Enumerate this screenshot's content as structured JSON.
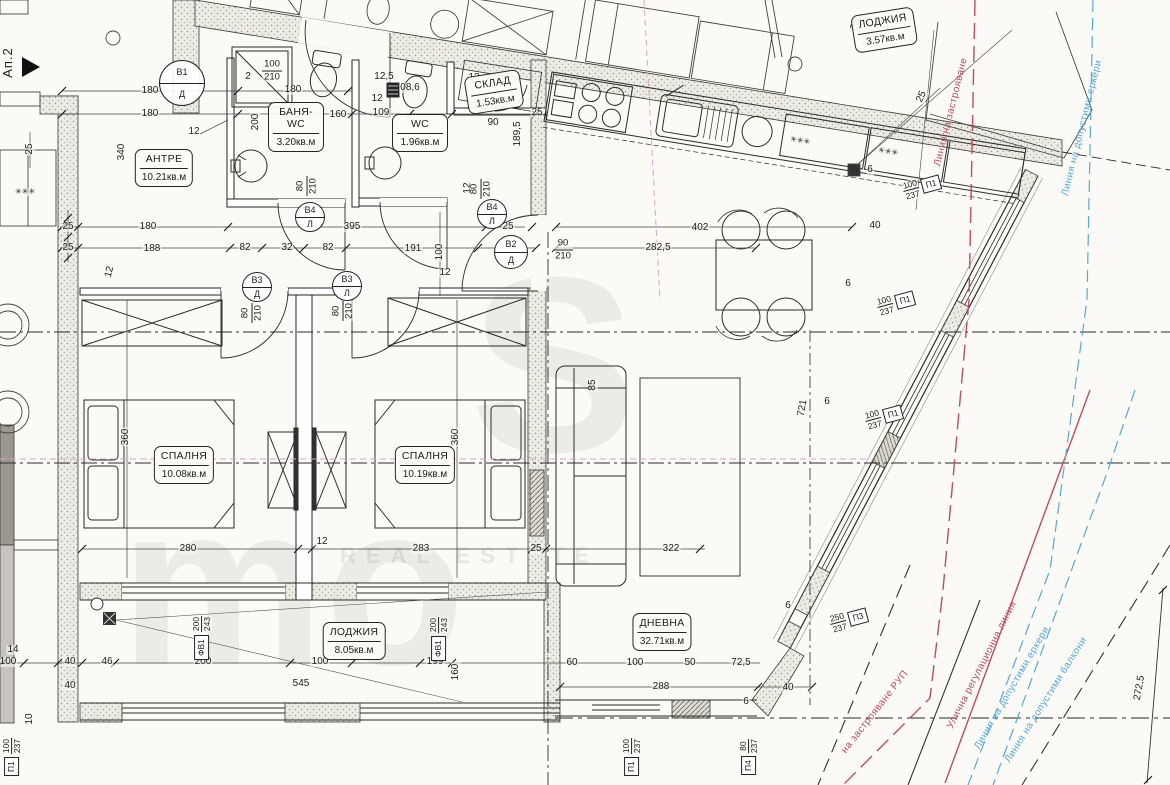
{
  "meta": {
    "apartment": "Ап.2",
    "colors": {
      "red_line": "#b94f63",
      "blue_line": "#58a8d5",
      "ink": "#1d1d1b"
    }
  },
  "watermark": {
    "letters1": "S",
    "letters2": "mo",
    "caption": "REAL ESTATE"
  },
  "rooms": [
    {
      "name": "АНТРЕ",
      "area": "10.21кв.м",
      "x": 164,
      "y": 168
    },
    {
      "name": "БАНЯ-WC",
      "area": "3.20кв.м",
      "x": 296,
      "y": 127
    },
    {
      "name": "WC",
      "area": "1.96кв.м",
      "x": 420,
      "y": 133
    },
    {
      "name": "СКЛАД",
      "area": "1.53кв.м",
      "x": 494,
      "y": 92,
      "r": -9
    },
    {
      "name": "СПАЛНЯ",
      "area": "10.08кв.м",
      "x": 184,
      "y": 465
    },
    {
      "name": "СПАЛНЯ",
      "area": "10.19кв.м",
      "x": 425,
      "y": 465
    },
    {
      "name": "ДНЕВНА",
      "area": "32.71кв.м",
      "x": 662,
      "y": 632
    },
    {
      "name": "ЛОДЖИЯ",
      "area": "8.05кв.м",
      "x": 354,
      "y": 641
    },
    {
      "name": "ЛОДЖИЯ",
      "area": "3.57кв.м",
      "x": 884,
      "y": 30,
      "r": -9
    }
  ],
  "door_markers": [
    {
      "top": "В1",
      "bottom": "Д",
      "x": 182,
      "y": 83,
      "s": 46
    },
    {
      "top": "В2",
      "bottom": "Д",
      "x": 511,
      "y": 252,
      "s": 34
    },
    {
      "top": "В3",
      "bottom": "Д",
      "x": 257,
      "y": 287,
      "s": 30
    },
    {
      "top": "В3",
      "bottom": "Л",
      "x": 347,
      "y": 286,
      "s": 30
    },
    {
      "top": "В4",
      "bottom": "Л",
      "x": 310,
      "y": 217,
      "s": 30
    },
    {
      "top": "В4",
      "bottom": "Л",
      "x": 492,
      "y": 214,
      "s": 30
    }
  ],
  "fractions": [
    {
      "a": "100",
      "b": "210",
      "x": 272,
      "y": 71
    },
    {
      "a": "90",
      "b": "210",
      "x": 563,
      "y": 250
    },
    {
      "a": "80",
      "b": "210",
      "x": 252,
      "y": 313,
      "r": -90
    },
    {
      "a": "80",
      "b": "210",
      "x": 343,
      "y": 311,
      "r": -90
    },
    {
      "a": "80",
      "b": "210",
      "x": 307,
      "y": 186,
      "r": -90
    },
    {
      "a": "80",
      "b": "210",
      "x": 481,
      "y": 189,
      "r": -90
    }
  ],
  "win_markers": [
    {
      "a": "100",
      "b": "237",
      "tag": "П1",
      "x": 922,
      "y": 187,
      "r": -15
    },
    {
      "a": "100",
      "b": "237",
      "tag": "П1",
      "x": 896,
      "y": 303,
      "r": -15
    },
    {
      "a": "100",
      "b": "237",
      "tag": "П1",
      "x": 884,
      "y": 417,
      "r": -15
    },
    {
      "a": "250",
      "b": "237",
      "tag": "П3",
      "x": 849,
      "y": 620,
      "r": -15
    },
    {
      "a": "100",
      "b": "237",
      "tag": "П1",
      "x": 632,
      "y": 757,
      "r": -90,
      "cls": "v"
    },
    {
      "a": "80",
      "b": "237",
      "tag": "П4",
      "x": 749,
      "y": 757,
      "r": -90,
      "cls": "v"
    },
    {
      "a": "100",
      "b": "237",
      "tag": "П1",
      "x": 12,
      "y": 757,
      "r": -90,
      "cls": "v"
    },
    {
      "a": "200",
      "b": "243",
      "tag": "ФВ1",
      "x": 202,
      "y": 638,
      "r": -90,
      "cls": "v"
    },
    {
      "a": "200",
      "b": "243",
      "tag": "ФВ1",
      "x": 439,
      "y": 639,
      "r": -90,
      "cls": "v"
    }
  ],
  "line_labels": [
    {
      "t": "Линия на застрояване",
      "x": 951,
      "y": 112,
      "r": -76,
      "c": "#b94f63"
    },
    {
      "t": "Линия на допустими еркери",
      "x": 1082,
      "y": 128,
      "r": -76,
      "c": "#58a8d5"
    },
    {
      "t": "Улична регулационна линия",
      "x": 982,
      "y": 665,
      "r": -63,
      "c": "#b94f63"
    },
    {
      "t": "Линия на допустими еркери",
      "x": 1012,
      "y": 688,
      "r": -60,
      "c": "#58a8d5"
    },
    {
      "t": "Линия на допустими балкони",
      "x": 1046,
      "y": 700,
      "r": -58,
      "c": "#58a8d5"
    },
    {
      "t": "на застрояване РУП",
      "x": 875,
      "y": 712,
      "r": -52,
      "c": "#b94f63"
    }
  ],
  "dims": [
    {
      "t": "25",
      "x": 68,
      "y": 227
    },
    {
      "t": "180",
      "x": 148,
      "y": 227
    },
    {
      "t": "395",
      "x": 352,
      "y": 227
    },
    {
      "t": "25",
      "x": 508,
      "y": 227
    },
    {
      "t": "402",
      "x": 700,
      "y": 228
    },
    {
      "t": "25",
      "x": 68,
      "y": 248
    },
    {
      "t": "188",
      "x": 152,
      "y": 249
    },
    {
      "t": "82",
      "x": 245,
      "y": 248
    },
    {
      "t": "32",
      "x": 287,
      "y": 248
    },
    {
      "t": "82",
      "x": 328,
      "y": 248
    },
    {
      "t": "191",
      "x": 413,
      "y": 249
    },
    {
      "t": "100",
      "x": 440,
      "y": 252,
      "r": -90
    },
    {
      "t": "282,5",
      "x": 658,
      "y": 248
    },
    {
      "t": "180",
      "x": 150,
      "y": 91
    },
    {
      "t": "180",
      "x": 150,
      "y": 114
    },
    {
      "t": "180",
      "x": 293,
      "y": 90
    },
    {
      "t": "160",
      "x": 338,
      "y": 115
    },
    {
      "t": "109",
      "x": 381,
      "y": 113
    },
    {
      "t": "12",
      "x": 377,
      "y": 99
    },
    {
      "t": "12,5",
      "x": 384,
      "y": 77
    },
    {
      "t": "08,6",
      "x": 410,
      "y": 88
    },
    {
      "t": "12",
      "x": 474,
      "y": 78
    },
    {
      "t": "90",
      "x": 493,
      "y": 123
    },
    {
      "t": "189,5",
      "x": 518,
      "y": 134,
      "r": -90
    },
    {
      "t": "25",
      "x": 537,
      "y": 113
    },
    {
      "t": "12",
      "x": 194,
      "y": 132
    },
    {
      "t": "200",
      "x": 256,
      "y": 122,
      "r": -90
    },
    {
      "t": "340",
      "x": 122,
      "y": 152,
      "r": -90
    },
    {
      "t": "25",
      "x": 30,
      "y": 149,
      "r": -90
    },
    {
      "t": "2",
      "x": 248,
      "y": 77
    },
    {
      "t": "12",
      "x": 110,
      "y": 272,
      "r": -75
    },
    {
      "t": "✳✳✳",
      "x": 25,
      "y": 192,
      "fs": 8
    },
    {
      "t": "✳✳✳",
      "x": 800,
      "y": 141,
      "r": 9,
      "fs": 8
    },
    {
      "t": "✳✳✳",
      "x": 888,
      "y": 152,
      "r": 9,
      "fs": 8
    },
    {
      "t": "25",
      "x": 856,
      "y": 25,
      "r": -65
    },
    {
      "t": "25",
      "x": 922,
      "y": 97,
      "r": -65
    },
    {
      "t": "40",
      "x": 875,
      "y": 226
    },
    {
      "t": "6",
      "x": 870,
      "y": 170
    },
    {
      "t": "6",
      "x": 848,
      "y": 284
    },
    {
      "t": "6",
      "x": 827,
      "y": 402
    },
    {
      "t": "6",
      "x": 788,
      "y": 606
    },
    {
      "t": "721",
      "x": 803,
      "y": 408,
      "r": -80
    },
    {
      "t": "272,5",
      "x": 1140,
      "y": 688,
      "r": -80
    },
    {
      "t": "360",
      "x": 126,
      "y": 437,
      "r": -90
    },
    {
      "t": "360",
      "x": 456,
      "y": 437,
      "r": -90
    },
    {
      "t": "280",
      "x": 188,
      "y": 549
    },
    {
      "t": "12",
      "x": 322,
      "y": 542
    },
    {
      "t": "283",
      "x": 421,
      "y": 549
    },
    {
      "t": "25",
      "x": 536,
      "y": 549
    },
    {
      "t": "322",
      "x": 671,
      "y": 549
    },
    {
      "t": "12",
      "x": 445,
      "y": 273
    },
    {
      "t": "85",
      "x": 593,
      "y": 385,
      "r": -90
    },
    {
      "t": "12",
      "x": 468,
      "y": 188,
      "r": -90
    },
    {
      "t": "14",
      "x": 13,
      "y": 650
    },
    {
      "t": "100",
      "x": 8,
      "y": 662
    },
    {
      "t": "40",
      "x": 70,
      "y": 662
    },
    {
      "t": "40",
      "x": 70,
      "y": 686
    },
    {
      "t": "46",
      "x": 107,
      "y": 662
    },
    {
      "t": "10",
      "x": 30,
      "y": 719,
      "r": -90
    },
    {
      "t": "200",
      "x": 203,
      "y": 662
    },
    {
      "t": "100",
      "x": 320,
      "y": 662
    },
    {
      "t": "545",
      "x": 301,
      "y": 684
    },
    {
      "t": "199",
      "x": 435,
      "y": 662
    },
    {
      "t": "160",
      "x": 456,
      "y": 672,
      "r": -90
    },
    {
      "t": "60",
      "x": 572,
      "y": 663
    },
    {
      "t": "100",
      "x": 635,
      "y": 663
    },
    {
      "t": "50",
      "x": 690,
      "y": 663
    },
    {
      "t": "72,5",
      "x": 741,
      "y": 663
    },
    {
      "t": "288",
      "x": 661,
      "y": 687
    },
    {
      "t": "40",
      "x": 788,
      "y": 688
    },
    {
      "t": "6",
      "x": 746,
      "y": 702
    }
  ]
}
